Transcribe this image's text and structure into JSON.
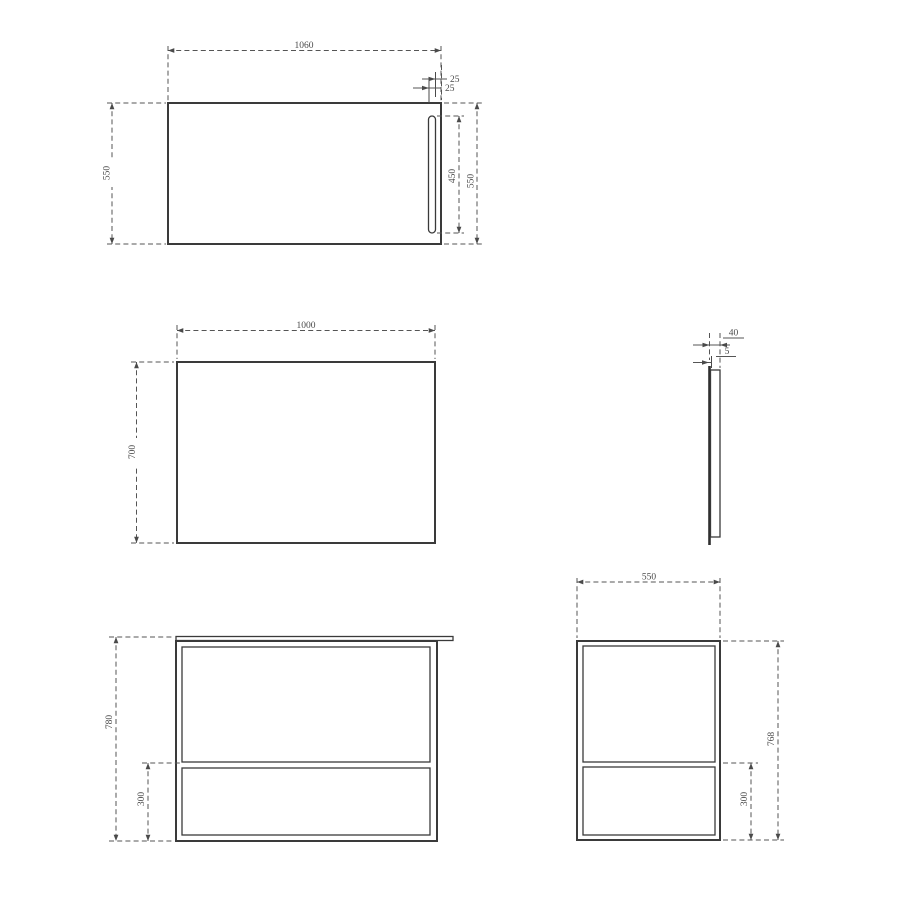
{
  "drawing": {
    "palette": {
      "outline_color": "#3a3a3a",
      "dimension_color": "#555555",
      "background": "#ffffff"
    },
    "views": {
      "mirror_front": {
        "dims": {
          "width": "1060",
          "height_left": "550",
          "height_right": "550",
          "slot_height": "450",
          "slot_edge_offset": "25",
          "slot_width": "25"
        }
      },
      "panel_front": {
        "dims": {
          "width": "1000",
          "height": "700"
        }
      },
      "mirror_side": {
        "dims": {
          "depth": "40",
          "glass_thickness": "5"
        }
      },
      "vanity_front": {
        "dims": {
          "height": "780",
          "lower_shelf_height": "300"
        }
      },
      "vanity_side": {
        "dims": {
          "depth": "550",
          "height": "768",
          "lower_shelf_height": "300"
        }
      }
    }
  }
}
